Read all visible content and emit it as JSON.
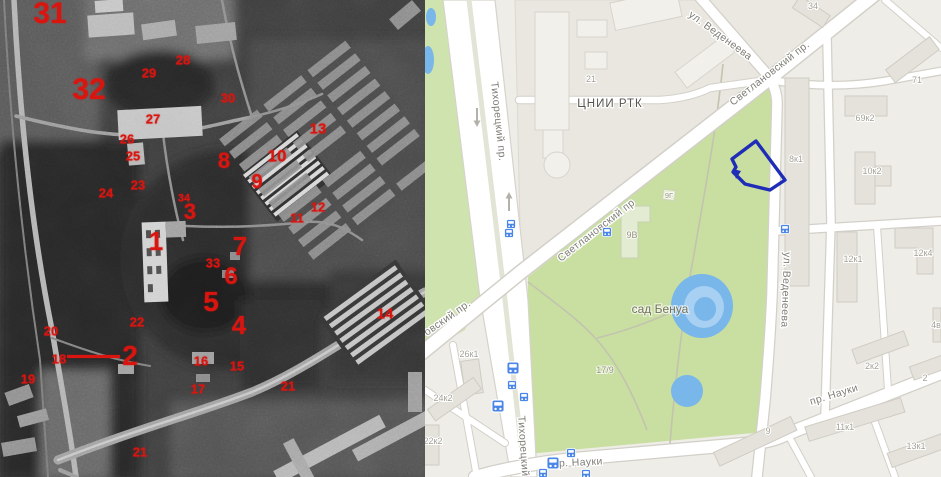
{
  "left_photo": {
    "annotation_color": "#d91510",
    "annotations": [
      {
        "label": "31"
      },
      {
        "label": "32"
      },
      {
        "label": "30"
      },
      {
        "label": "29"
      },
      {
        "label": "28"
      },
      {
        "label": "27"
      },
      {
        "label": "26"
      },
      {
        "label": "25"
      },
      {
        "label": "24"
      },
      {
        "label": "23"
      },
      {
        "label": "13"
      },
      {
        "label": "10"
      },
      {
        "label": "9"
      },
      {
        "label": "8"
      },
      {
        "label": "34"
      },
      {
        "label": "3"
      },
      {
        "label": "12"
      },
      {
        "label": "11"
      },
      {
        "label": "1"
      },
      {
        "label": "7"
      },
      {
        "label": "33"
      },
      {
        "label": "6"
      },
      {
        "label": "5"
      },
      {
        "label": "4"
      },
      {
        "label": "22"
      },
      {
        "label": "2"
      },
      {
        "label": "20"
      },
      {
        "label": "18"
      },
      {
        "label": "19"
      },
      {
        "label": "16"
      },
      {
        "label": "15"
      },
      {
        "label": "17"
      },
      {
        "label": "14"
      },
      {
        "label": "21"
      },
      {
        "label": "21"
      }
    ]
  },
  "map": {
    "street_labels": {
      "tikhoretsky_top": "Тихорецкий пр.",
      "tikhoretsky_bottom": "Тихорецкий",
      "svetlanovsky_mid": "Светлановский пр",
      "svetlanovsky_top": "Светлановский пр.",
      "svetlanovsky_left": "овский пр.",
      "vedeneeva_top": "ул. Веденеева",
      "vedeneeva_right": "ул. Веденеева",
      "nauki_bottom": "пр. Науки",
      "nauki_right": "пр. Науки"
    },
    "place_labels": {
      "park": "сад Бенуа",
      "institute": "ЦНИИ РТК",
      "b21": "21",
      "b34": "34",
      "b71": "71",
      "b69k2": "69к2",
      "b8k1": "8к1",
      "b10k2": "10к2",
      "b12k4": "12к4",
      "b12k1": "12к1",
      "b9v": "9В",
      "b9g": "9Г",
      "b17_9": "17/9",
      "b26k1": "26к1",
      "b24k2": "24к2",
      "b22k2": "22к2",
      "b2k2": "2к2",
      "b2": "2",
      "b4v": "4в",
      "b11k1": "11к1",
      "b9": "9",
      "b13k1": "13к1"
    },
    "colors": {
      "park_green": "#c9dfa1",
      "water_blue": "#79b6e9",
      "road_white": "#ffffff",
      "campus_grey": "#e9e7e0",
      "residential": "#efede7",
      "selection_blue": "#1e2cb8",
      "transit_blue": "#4a86e8"
    }
  }
}
